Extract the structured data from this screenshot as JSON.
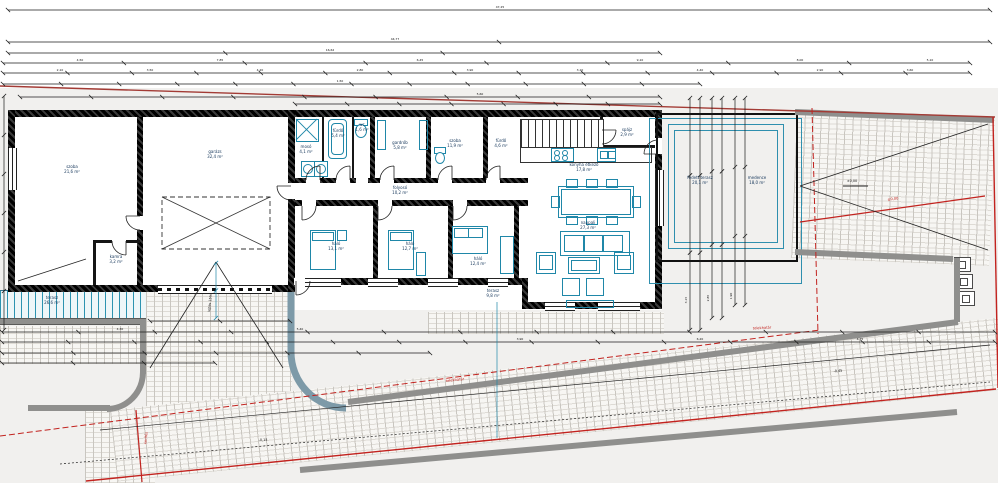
{
  "drawing": {
    "type": "architectural-floor-plan",
    "units": "m",
    "colors": {
      "fixture_teal": "#1f87a8",
      "pool_blue": "#2f8fae",
      "boundary_red": "#c2231f",
      "site_red_top": "#a33b35",
      "wall_black": "#161616",
      "curb_gray": "#8f8f8d",
      "ramp_edge_blue_gray": "#7d9aa8",
      "label_navy": "#15365a",
      "paving": "#f7f6f3"
    }
  },
  "rooms": [
    {
      "id": "szoba-1",
      "label": "szoba",
      "area": "21,6 m²",
      "x": 72,
      "y": 170
    },
    {
      "id": "garazs",
      "label": "garázs",
      "area": "32,4 m²",
      "x": 215,
      "y": 155
    },
    {
      "id": "kamra",
      "label": "kamra",
      "area": "3,2 m²",
      "x": 116,
      "y": 260
    },
    {
      "id": "moso",
      "label": "mosó",
      "area": "4,1 m²",
      "x": 306,
      "y": 150
    },
    {
      "id": "furdo-1",
      "label": "fürdő",
      "area": "5,4 m²",
      "x": 338,
      "y": 134
    },
    {
      "id": "wc",
      "label": "wc",
      "area": "1,6 m²",
      "x": 362,
      "y": 128
    },
    {
      "id": "gardrob",
      "label": "gardrób",
      "area": "5,8 m²",
      "x": 400,
      "y": 146
    },
    {
      "id": "szoba-2",
      "label": "szoba",
      "area": "11,9 m²",
      "x": 455,
      "y": 144
    },
    {
      "id": "furdo-2",
      "label": "fürdő",
      "area": "4,6 m²",
      "x": 501,
      "y": 144
    },
    {
      "id": "folyoso",
      "label": "folyosó",
      "area": "10,2 m²",
      "x": 400,
      "y": 191
    },
    {
      "id": "halo-1",
      "label": "háló",
      "area": "13,1 m²",
      "x": 336,
      "y": 247
    },
    {
      "id": "halo-2",
      "label": "háló",
      "area": "12,7 m²",
      "x": 410,
      "y": 247
    },
    {
      "id": "halo-3",
      "label": "háló",
      "area": "12,4 m²",
      "x": 478,
      "y": 262
    },
    {
      "id": "konyha",
      "label": "konyha étkező",
      "area": "17,8 m²",
      "x": 584,
      "y": 168
    },
    {
      "id": "nappali",
      "label": "nappali",
      "area": "27,3 m²",
      "x": 588,
      "y": 226
    },
    {
      "id": "spajz",
      "label": "spájz",
      "area": "2,9 m²",
      "x": 627,
      "y": 133
    },
    {
      "id": "fedett-terasz",
      "label": "fedett terasz",
      "area": "20,1 m²",
      "x": 700,
      "y": 181
    },
    {
      "id": "medence",
      "label": "medence",
      "area": "18,0 m²",
      "x": 757,
      "y": 181
    },
    {
      "id": "terasz",
      "label": "terasz",
      "area": "26,6 m²",
      "x": 52,
      "y": 301
    },
    {
      "id": "terasz-2",
      "label": "terasz",
      "area": "9,8 m²",
      "x": 493,
      "y": 294
    }
  ],
  "texts": {
    "red": [
      {
        "t": "telekhatár",
        "x": 455,
        "y": 380,
        "rot": -7
      },
      {
        "t": "telekhatár",
        "x": 762,
        "y": 328,
        "rot": -3
      },
      {
        "t": "±0,00",
        "x": 893,
        "y": 199,
        "rot": -6
      },
      {
        "t": "kerítés",
        "x": 146,
        "y": 438,
        "rot": -85
      }
    ],
    "black": [
      {
        "t": "±0,00",
        "x": 852,
        "y": 181,
        "rot": 0
      },
      {
        "t": "-0,15",
        "x": 263,
        "y": 440,
        "rot": 0
      },
      {
        "t": "-0,45",
        "x": 838,
        "y": 371,
        "rot": -5
      },
      {
        "t": "lejtés 15%",
        "x": 210,
        "y": 303,
        "rot": -84
      }
    ],
    "dims": [
      {
        "t": "47,25",
        "x": 500,
        "y": 7
      },
      {
        "t": "44,77",
        "x": 395,
        "y": 39
      },
      {
        "t": "16,62",
        "x": 330,
        "y": 50
      },
      {
        "t": "4,50",
        "x": 80,
        "y": 60
      },
      {
        "t": "7,85",
        "x": 220,
        "y": 60
      },
      {
        "t": "6,45",
        "x": 420,
        "y": 60
      },
      {
        "t": "9,10",
        "x": 640,
        "y": 60
      },
      {
        "t": "8,00",
        "x": 800,
        "y": 60
      },
      {
        "t": "5,10",
        "x": 930,
        "y": 60
      },
      {
        "t": "2,10",
        "x": 60,
        "y": 70
      },
      {
        "t": "3,50",
        "x": 150,
        "y": 70
      },
      {
        "t": "4,20",
        "x": 260,
        "y": 70
      },
      {
        "t": "2,80",
        "x": 360,
        "y": 70
      },
      {
        "t": "3,90",
        "x": 470,
        "y": 70
      },
      {
        "t": "3,10",
        "x": 580,
        "y": 70
      },
      {
        "t": "4,40",
        "x": 700,
        "y": 70
      },
      {
        "t": "2,90",
        "x": 820,
        "y": 70
      },
      {
        "t": "3,60",
        "x": 910,
        "y": 70
      },
      {
        "t": "1,50",
        "x": 340,
        "y": 81
      },
      {
        "t": "5,60",
        "x": 480,
        "y": 94
      },
      {
        "t": "4,30",
        "x": 120,
        "y": 329
      },
      {
        "t": "5,40",
        "x": 300,
        "y": 329
      },
      {
        "t": "3,90",
        "x": 520,
        "y": 339
      },
      {
        "t": "6,20",
        "x": 700,
        "y": 339
      },
      {
        "t": "4,75",
        "x": 860,
        "y": 339
      },
      {
        "t": "3,15",
        "x": 686,
        "y": 300,
        "rot": -90
      },
      {
        "t": "2,85",
        "x": 708,
        "y": 298,
        "rot": -90
      },
      {
        "t": "1,90",
        "x": 731,
        "y": 296,
        "rot": -90
      }
    ]
  },
  "geometry": {
    "rects": [
      [
        "room",
        8,
        110,
        654,
        182,
        "building-left-block"
      ],
      [
        "room",
        295,
        110,
        367,
        200,
        "building-right-block"
      ],
      [
        "w",
        8,
        110,
        654,
        7,
        "wall-top"
      ],
      [
        "w",
        8,
        110,
        7,
        182,
        "wall-left"
      ],
      [
        "w",
        8,
        285,
        287,
        7,
        "wall-bottom-left-block"
      ],
      [
        "w",
        295,
        278,
        233,
        7,
        "wall-bottom-bedrooms"
      ],
      [
        "w",
        522,
        302,
        140,
        7,
        "wall-bottom-living"
      ],
      [
        "w",
        522,
        278,
        6,
        31,
        "wall-step"
      ],
      [
        "w",
        295,
        178,
        233,
        5,
        "wall-corridor-top"
      ],
      [
        "w",
        295,
        200,
        233,
        6,
        "wall-corridor-bottom"
      ],
      [
        "w",
        137,
        117,
        6,
        168,
        "wall-room1-garage"
      ],
      [
        "w",
        288,
        110,
        7,
        182,
        "wall-garage-right"
      ],
      [
        "w",
        370,
        117,
        5,
        61,
        "wall-int-1"
      ],
      [
        "w",
        426,
        117,
        5,
        61,
        "wall-int-2"
      ],
      [
        "w",
        483,
        117,
        5,
        61,
        "wall-int-3"
      ],
      [
        "w",
        373,
        206,
        5,
        72,
        "wall-bed-1"
      ],
      [
        "w",
        448,
        206,
        5,
        72,
        "wall-bed-2"
      ],
      [
        "w",
        514,
        206,
        5,
        72,
        "wall-bed-3"
      ],
      [
        "w",
        655,
        110,
        7,
        199,
        "wall-right"
      ],
      [
        "wt",
        322,
        117,
        2,
        61,
        "partition-1"
      ],
      [
        "wt",
        352,
        117,
        2,
        61,
        "partition-2"
      ],
      [
        "wt",
        600,
        117,
        3,
        31,
        "pantry-wall-v"
      ],
      [
        "wt",
        600,
        145,
        58,
        3,
        "pantry-wall-h"
      ],
      [
        "wt",
        93,
        240,
        47,
        3,
        "kamra-wall-h"
      ],
      [
        "wt",
        93,
        243,
        3,
        42,
        "kamra-wall-v"
      ],
      [
        "gap",
        306,
        178,
        14,
        6
      ],
      [
        "gap",
        336,
        178,
        14,
        6
      ],
      [
        "gap",
        356,
        178,
        12,
        6
      ],
      [
        "gap",
        380,
        178,
        14,
        6
      ],
      [
        "gap",
        438,
        178,
        14,
        6
      ],
      [
        "gap",
        486,
        178,
        14,
        6
      ],
      [
        "gap",
        302,
        200,
        14,
        7
      ],
      [
        "gap",
        378,
        200,
        14,
        7
      ],
      [
        "gap",
        453,
        200,
        14,
        7
      ],
      [
        "gap",
        288,
        183,
        7,
        16
      ],
      [
        "gap",
        137,
        216,
        6,
        14
      ],
      [
        "gap",
        112,
        240,
        14,
        3
      ],
      [
        "gap",
        294,
        278,
        16,
        7
      ],
      [
        "gap",
        600,
        130,
        3,
        14
      ],
      [
        "gap",
        655,
        138,
        7,
        16
      ],
      [
        "win",
        305,
        278,
        36,
        7,
        "window-bed1"
      ],
      [
        "win",
        368,
        278,
        30,
        7,
        "window-bed2"
      ],
      [
        "win",
        428,
        278,
        30,
        7,
        "window-bed3"
      ],
      [
        "win",
        488,
        278,
        20,
        7,
        "window-bed4"
      ],
      [
        "win",
        545,
        302,
        30,
        7,
        "window-living1"
      ],
      [
        "win",
        598,
        302,
        42,
        7,
        "window-living2"
      ],
      [
        "winv",
        8,
        148,
        7,
        42,
        "window-room1"
      ],
      [
        "winv",
        655,
        170,
        7,
        56,
        "terrace-slider"
      ],
      [
        "gate",
        158,
        285,
        114,
        7,
        "garage-gate"
      ],
      [
        "f",
        296,
        119,
        21,
        21,
        "shower"
      ],
      [
        "f rnd",
        328,
        119,
        17,
        38,
        "bathtub"
      ],
      [
        "f rnd",
        331,
        123,
        11,
        30,
        "bathtub-inner"
      ],
      [
        "ff",
        301,
        161,
        12,
        14,
        "washer-1"
      ],
      [
        "ff",
        314,
        161,
        12,
        14,
        "washer-2"
      ],
      [
        "fc",
        303,
        164,
        8,
        8,
        "washer-1-drum"
      ],
      [
        "fc",
        316,
        164,
        8,
        8,
        "washer-2-drum"
      ],
      [
        "f",
        354,
        119,
        12,
        5,
        "wc-tank"
      ],
      [
        "fc",
        355,
        124,
        10,
        12,
        "wc-bowl"
      ],
      [
        "f",
        434,
        147,
        10,
        5,
        "wc2-tank"
      ],
      [
        "fc",
        435,
        152,
        8,
        10,
        "wc2-bowl"
      ],
      [
        "f",
        545,
        119,
        11,
        26,
        "fridge"
      ],
      [
        "f",
        377,
        120,
        7,
        28,
        "wardrobe-shelf-1"
      ],
      [
        "f",
        419,
        120,
        7,
        28,
        "wardrobe-shelf-2"
      ],
      [
        "cab",
        520,
        119,
        82,
        27,
        "kitchen-cabinets"
      ],
      [
        "blk",
        520,
        147,
        130,
        14,
        "kitchen-counter"
      ],
      [
        "f",
        551,
        148,
        21,
        12,
        "stove"
      ],
      [
        "fc",
        554,
        150,
        4,
        4
      ],
      [
        "fc",
        562,
        150,
        4,
        4
      ],
      [
        "fc",
        554,
        155,
        4,
        4
      ],
      [
        "fc",
        562,
        155,
        4,
        4
      ],
      [
        "f",
        597,
        148,
        17,
        12,
        "sink"
      ],
      [
        "f",
        600,
        151,
        6,
        6
      ],
      [
        "f",
        608,
        151,
        6,
        6
      ],
      [
        "f",
        558,
        186,
        74,
        30,
        "dining-table"
      ],
      [
        "f",
        561,
        189,
        68,
        24,
        "dining-table-inner"
      ],
      [
        "f",
        566,
        179,
        10,
        7
      ],
      [
        "f",
        586,
        179,
        10,
        7
      ],
      [
        "f",
        606,
        179,
        10,
        7
      ],
      [
        "f",
        566,
        216,
        10,
        7
      ],
      [
        "f",
        586,
        216,
        10,
        7
      ],
      [
        "f",
        606,
        216,
        10,
        7
      ],
      [
        "f",
        551,
        196,
        7,
        10
      ],
      [
        "f",
        632,
        196,
        7,
        10
      ],
      [
        "f",
        560,
        231,
        68,
        23,
        "sofa"
      ],
      [
        "f",
        564,
        235,
        19,
        15
      ],
      [
        "f",
        583,
        235,
        19,
        15
      ],
      [
        "f",
        602,
        235,
        19,
        15
      ],
      [
        "f",
        536,
        252,
        18,
        20,
        "armchair-left"
      ],
      [
        "f",
        539,
        255,
        12,
        13
      ],
      [
        "f",
        614,
        252,
        18,
        20,
        "armchair-right"
      ],
      [
        "f",
        617,
        255,
        12,
        13
      ],
      [
        "f",
        568,
        257,
        30,
        15,
        "coffee-table"
      ],
      [
        "f",
        571,
        260,
        24,
        9
      ],
      [
        "f",
        562,
        278,
        16,
        16,
        "pouf-1"
      ],
      [
        "f",
        586,
        278,
        16,
        16,
        "pouf-2"
      ],
      [
        "f",
        566,
        300,
        46,
        6,
        "tv-bench"
      ],
      [
        "f",
        310,
        230,
        24,
        38,
        "bed-1"
      ],
      [
        "f",
        312,
        232,
        20,
        7
      ],
      [
        "f",
        337,
        230,
        8,
        9
      ],
      [
        "f",
        388,
        230,
        24,
        38,
        "bed-2"
      ],
      [
        "f",
        390,
        232,
        20,
        7
      ],
      [
        "f",
        416,
        252,
        8,
        22
      ],
      [
        "f",
        452,
        226,
        34,
        26,
        "bed-3"
      ],
      [
        "f",
        454,
        228,
        13,
        8
      ],
      [
        "f",
        468,
        228,
        13,
        8
      ],
      [
        "f",
        500,
        236,
        12,
        36,
        "wardrobe-3"
      ],
      [
        "pb",
        649,
        118,
        151,
        164,
        "pool-blue-outer"
      ],
      [
        "pk",
        656,
        113,
        138,
        145,
        "pool-black-frame"
      ],
      [
        "pb",
        668,
        124,
        114,
        123,
        "pool-blue-inner"
      ],
      [
        "pb2",
        674,
        130,
        102,
        111,
        "pool-blue-inner2"
      ],
      [
        "sq2",
        954,
        257,
        15,
        13,
        "planter-1"
      ],
      [
        "sqi",
        958,
        261,
        6,
        6
      ],
      [
        "sq2",
        956,
        274,
        15,
        13,
        "planter-2"
      ],
      [
        "sqi",
        960,
        278,
        6,
        6
      ],
      [
        "sq2",
        958,
        291,
        15,
        13,
        "planter-3"
      ],
      [
        "sqi",
        962,
        295,
        6,
        6
      ],
      [
        "curb",
        0,
        318,
        146,
        5,
        "deck-curb"
      ]
    ],
    "paved": [
      [
        "brick",
        146,
        290,
        146,
        122,
        "ramp-paving"
      ],
      [
        "brick",
        428,
        312,
        236,
        22,
        "path-paving"
      ],
      [
        "brick",
        0,
        326,
        144,
        38,
        "left-path-paving"
      ],
      [
        "brick",
        85,
        408,
        70,
        75,
        "corner-paving"
      ],
      [
        "brick rot2",
        797,
        112,
        198,
        146,
        "right-pad-paving"
      ],
      [
        "brick rotm6",
        110,
        410,
        1040,
        72,
        "street-strip-paving"
      ],
      [
        "deck",
        0,
        290,
        146,
        28,
        "wood-deck"
      ],
      [
        "stairs",
        14,
        256,
        76,
        28,
        "stairs"
      ]
    ],
    "dims": [
      [
        8,
        10,
        990,
        10,
        2
      ],
      [
        8,
        42,
        990,
        42,
        3
      ],
      [
        8,
        53,
        660,
        53,
        4
      ],
      [
        3,
        63,
        970,
        63,
        9
      ],
      [
        3,
        73,
        970,
        73,
        16
      ],
      [
        3,
        84,
        700,
        84,
        13
      ],
      [
        20,
        97,
        660,
        97,
        10
      ],
      [
        295,
        104,
        660,
        104,
        8
      ],
      [
        4,
        96,
        4,
        330,
        7
      ],
      [
        2,
        332,
        995,
        332,
        14
      ],
      [
        2,
        342,
        995,
        342,
        16
      ],
      [
        2,
        353,
        430,
        353,
        7
      ],
      [
        2,
        363,
        215,
        363,
        4
      ],
      [
        150,
        321,
        290,
        321,
        3
      ],
      [
        690,
        98,
        690,
        330,
        4
      ],
      [
        700,
        98,
        700,
        330,
        4
      ],
      [
        712,
        98,
        712,
        318,
        4
      ],
      [
        722,
        98,
        722,
        318,
        4
      ],
      [
        735,
        98,
        735,
        305,
        4
      ],
      [
        745,
        98,
        745,
        305,
        4
      ],
      [
        216,
        263,
        216,
        318,
        3,
        "t"
      ],
      [
        497,
        302,
        497,
        438,
        0,
        "t"
      ]
    ]
  }
}
